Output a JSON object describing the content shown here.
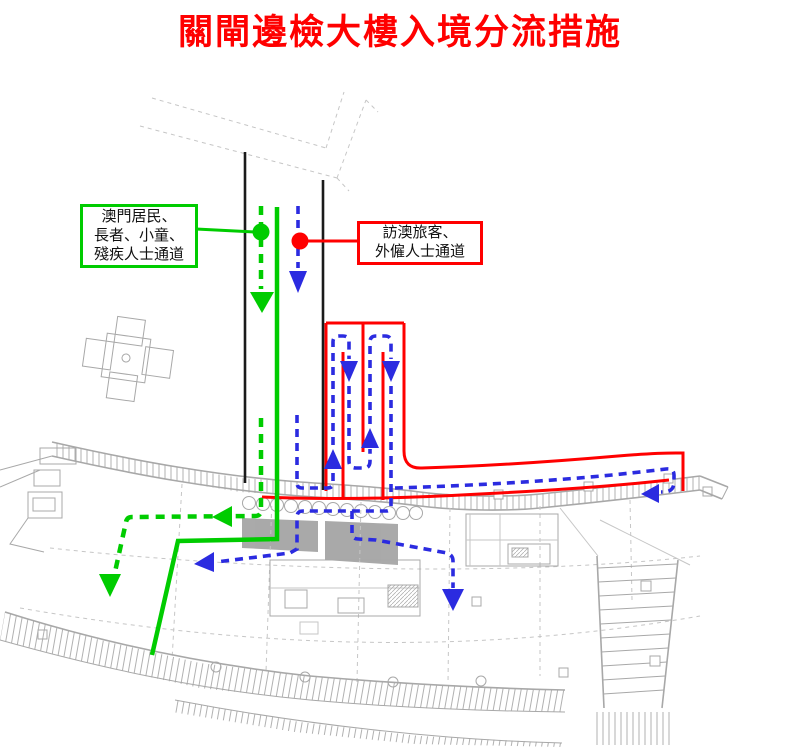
{
  "title": "關閘邊檢大樓入境分流措施",
  "labels": {
    "green_box": {
      "line1": "澳門居民、",
      "line2": "長者、小童、",
      "line3": "殘疾人士通道"
    },
    "red_box": {
      "line1": "訪澳旅客、",
      "line2": "外僱人士通道"
    }
  },
  "routes": [
    {
      "name": "resident-route",
      "label": "澳門居民、長者、小童、殘疾人士通道",
      "style": "green solid and dashed arrows"
    },
    {
      "name": "visitor-route",
      "label": "訪澳旅客、外僱人士通道",
      "style": "blue dashed arrows inside red barrier lines"
    }
  ],
  "colors": {
    "title_red": "#ff0000",
    "barrier_red": "#ff0000",
    "resident_green": "#00cc00",
    "visitor_blue": "#2b2be0",
    "wall_black": "#1a1a1a",
    "plan_gray": "#a8a8a8",
    "plan_gray_light": "#c6c6c6",
    "booth_gray": "#9e9e9e",
    "label_text": "#111111",
    "background": "#ffffff"
  }
}
